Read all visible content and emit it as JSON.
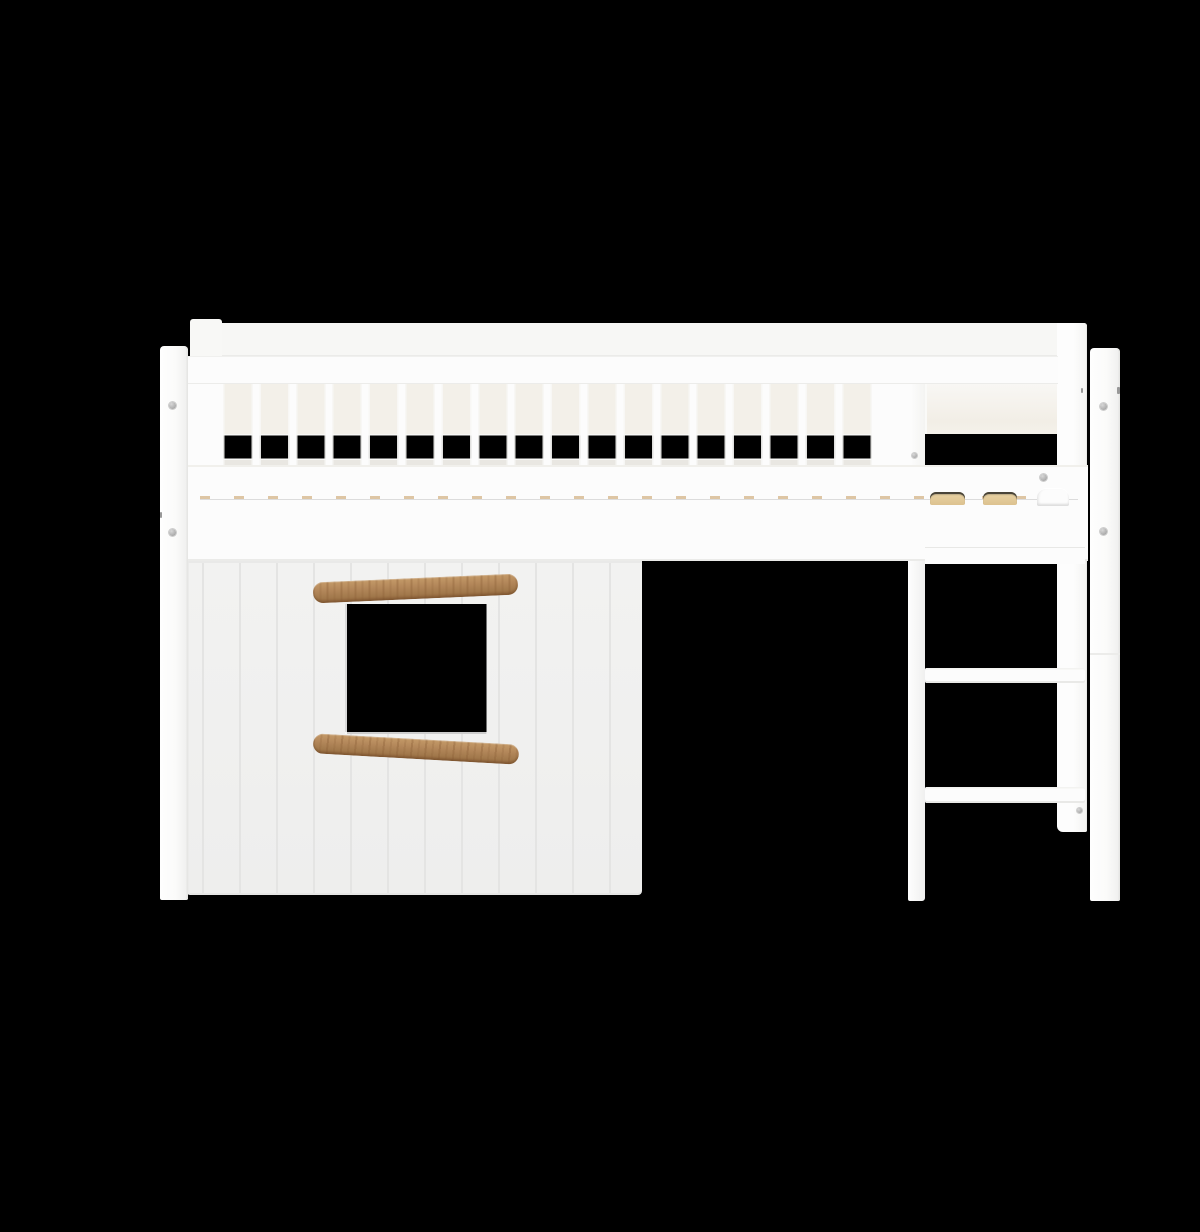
{
  "scene": {
    "title": "White mid-sleeper kids bed with treehouse front panel, window opening, oak handles and straight ladder",
    "description": "Product photo of a white mid-sleeper loft bed on a black background. The bed has a slatted safety guard rail along the top, a solid guard section above the ladder, a treehouse-style lower front panel with plank grooves and a square window opening framed by two slanted oak handle bars, a straight white ladder on the right side, front posts with round metal bolt caps, and light wooden mattress slat ends visible at the bed base.",
    "background_color": "#000000"
  },
  "palette": {
    "frame_white": "#fcfcfc",
    "soft_white": "#f6f6f4",
    "panel_white": "#f1f1f0",
    "inner_cream": "#f3f0e9",
    "groove_gray": "#e3e3e2",
    "oak_mid": "#b3875a",
    "oak_dark": "#8d6138",
    "oak_light": "#c49a68",
    "slat_wood_tan": "#e6d0a2",
    "bolt_gray": "#b0b0b0",
    "background_black": "#000000"
  },
  "parts": {
    "guard_rail": {
      "label": "slatted safety guard rail",
      "slat_gap_count": 18
    },
    "solid_guard_panel": {
      "label": "solid guard panel above ladder"
    },
    "bed_rail": {
      "label": "bed side rail"
    },
    "mattress_slat_ends_visible": 2,
    "treehouse_panel": {
      "label": "treehouse front panel",
      "window_opening": true,
      "plank_grooves": true
    },
    "handles": {
      "label": "oak handle bars",
      "count": 2
    },
    "ladder": {
      "label": "straight ladder",
      "visible_rungs": 3
    },
    "posts": {
      "label": "front posts",
      "count": 2,
      "bolt_caps_per_post": 2
    }
  }
}
